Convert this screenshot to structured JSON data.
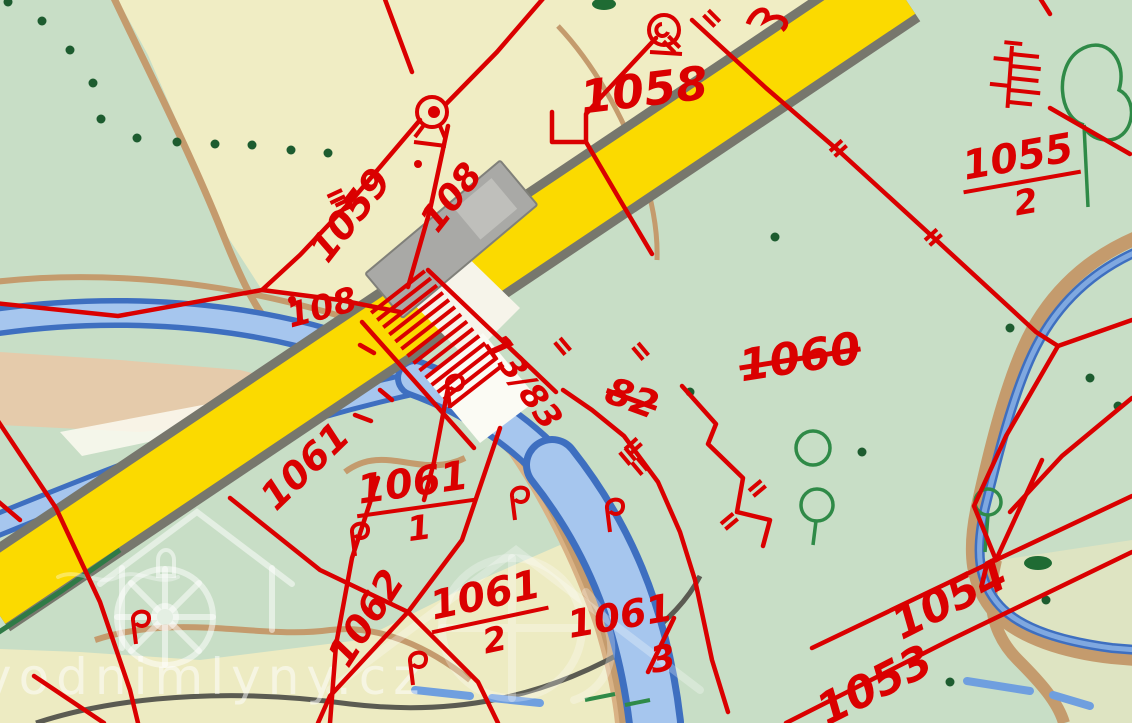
{
  "map": {
    "title": "cadastral-map",
    "watermark": {
      "site": "vodnimlyny.cz"
    },
    "parcels": {
      "p1058": {
        "label": "1058"
      },
      "p1055_2": {
        "num": "1055",
        "den": "2"
      },
      "p1060": {
        "label": "1060",
        "status": "struck"
      },
      "p1059": {
        "label": "1059"
      },
      "p108_a": {
        "label": "108"
      },
      "p108_b": {
        "label": "108"
      },
      "p13_83": {
        "label": "13/83"
      },
      "p82": {
        "label": "82",
        "status": "struck"
      },
      "p1061_road": {
        "label": "1061"
      },
      "p1061_1": {
        "num": "1061",
        "den": "1"
      },
      "p1062": {
        "label": "1062"
      },
      "p1061_2": {
        "num": "1061",
        "den": "2"
      },
      "p1061_3": {
        "num": "1061",
        "den": "3"
      },
      "p1054": {
        "label": "1054"
      },
      "p1053": {
        "label": "1053"
      }
    },
    "colors": {
      "boundary_red": "#da0000",
      "road_yellow": "#fbda00",
      "road_casing": "#77776d",
      "river_blue": "#a6c6ee",
      "river_edge_blue": "#3e6fc0",
      "field_cream": "#f0edc4",
      "meadow_green": "#c8dec6",
      "path_tan": "#c49b6d",
      "tree_green": "#2f8a47",
      "building_gray": "#a9a9a6"
    }
  }
}
